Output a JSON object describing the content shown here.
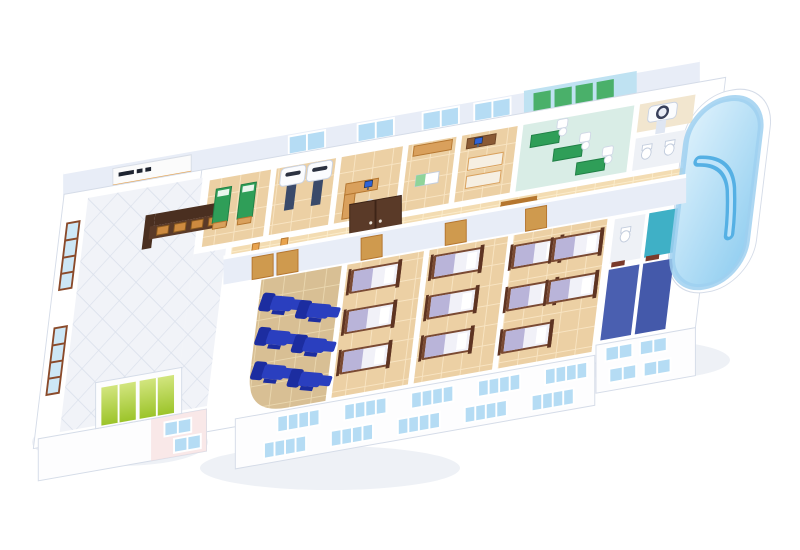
{
  "scene": {
    "title": "3D isometric cutaway floor plan of a hospital / clinic level",
    "view": "aerial isometric cutaway, building runs lower-left to upper-right on white background",
    "visible_text": "none legible (small dark glyphs on reception signboard only)"
  },
  "colors": {
    "shadow": "#eef1f6",
    "wall-edge": "#d5dce8",
    "wall-shade": "#e8edf7",
    "floor-beige": "#ecd0a4",
    "floor-tan": "#d8bf94",
    "floor-corridor": "#f3dcb2",
    "hall-tile": "#f1f3f8",
    "hall-grout": "#dbe1ec",
    "rehab-floor": "#d9ede6",
    "rehab-wall": "#bfe2f2",
    "panel-green": "#4ab06a",
    "green": "#2f9e58",
    "green-dark": "#1f7f45",
    "wood": "#d9a05c",
    "wood-dark": "#b5762f",
    "orange": "#e8a34e",
    "desk-brown": "#8a5a34",
    "chair-blue": "#2a3fbf",
    "chair-blue-dark": "#1c2da0",
    "bed-frame": "#7a4a33",
    "bed-frame-dark": "#5e3422",
    "bed-mattress": "#f1f1f8",
    "bed-blanket": "#b9b4d9",
    "scan-table": "#3a4a6a",
    "glass": "#b5dcf4",
    "glass-pale": "#cde7f6",
    "window-frame-brown": "#8a4a2a",
    "slate": "#4a5fb0",
    "slate2": "#4459aa",
    "teal": "#3fb0c6",
    "door-gold": "#cf9a4e",
    "door-red": "#7a3a2a",
    "door-brown": "#5a3a28",
    "counter-brown": "#4a2f20",
    "counter-brown2": "#5a3a28",
    "counter-orange": "#cd8a3f",
    "monitor-blue": "#2e63d8",
    "facade": "#fdfdfe",
    "pink-facade": "#f6dede",
    "elevator-green-1": "#d2e57e",
    "elevator-green-2": "#9cc42a",
    "atrium-light": "#dff2fc",
    "atrium-mid": "#8fcdf0",
    "counter-blue": "#55b0e4",
    "sign-dark": "#1e2430"
  },
  "rooms": [
    {
      "id": "reception-hall",
      "label": "Reception hall",
      "features": [
        "dark reception counter with 4 orange panels",
        "white signboard with dark glyphs and orange trim",
        "tall brown-framed windows on left wall",
        "green elevator doors",
        "white diamond tile floor"
      ]
    },
    {
      "id": "exam-room-green-beds",
      "label": "Exam room",
      "features": [
        "2 green examination beds"
      ]
    },
    {
      "id": "imaging-room",
      "label": "Imaging room",
      "features": [
        "2 white scanner gantries with dark patient tables"
      ]
    },
    {
      "id": "consult-office",
      "label": "Consulting office",
      "features": [
        "wood desk",
        "computer monitor",
        "glass sliding door"
      ]
    },
    {
      "id": "treatment-room",
      "label": "Treatment room",
      "features": [
        "wood cabinet",
        "small treatment bed"
      ]
    },
    {
      "id": "staff-office",
      "label": "Staff office",
      "features": [
        "desk with monitor",
        "2 exam tables"
      ]
    },
    {
      "id": "rehab-gym",
      "label": "Rehabilitation gym",
      "features": [
        "green wall panels",
        "3 green therapy mats",
        "white exercise machines",
        "light blue walls"
      ]
    },
    {
      "id": "ct-room",
      "label": "CT room",
      "features": [
        "white CT scanner"
      ]
    },
    {
      "id": "wc-room",
      "label": "Toilet room",
      "features": [
        "2 toilets"
      ]
    },
    {
      "id": "corridor",
      "label": "Corridor",
      "features": [
        "2 orange tables with stools",
        "2 wooden benches",
        "dark brown double door"
      ]
    },
    {
      "id": "infusion-lounge",
      "label": "Lounge",
      "features": [
        "6 blue recliner chairs",
        "curved outer corner"
      ]
    },
    {
      "id": "ward-a",
      "label": "Patient ward A",
      "features": [
        "3 wood-frame beds with lavender blankets"
      ]
    },
    {
      "id": "ward-b",
      "label": "Patient ward B",
      "features": [
        "3 wood-frame beds"
      ]
    },
    {
      "id": "ward-c",
      "label": "Patient ward C",
      "features": [
        "5 wood-frame beds"
      ]
    },
    {
      "id": "shower-block",
      "label": "Washroom block",
      "features": [
        "slate-blue tiled floors",
        "teal tiled floor",
        "toilet",
        "dark red doors"
      ]
    },
    {
      "id": "hydro-atrium",
      "label": "Curved glass atrium",
      "features": [
        "blue curved glass wall",
        "curved blue counter"
      ]
    }
  ],
  "furniture_counts": {
    "green-exam-beds": 2,
    "imaging-scanners": 2,
    "blue-recliners": 6,
    "ward-beds": 11,
    "corridor-benches": 2,
    "corridor-tables": 2,
    "stools": 6,
    "toilets": 3,
    "desks": 3,
    "computer-monitors": 3,
    "elevator-doors": 2,
    "rehab-mats": 3,
    "facade-window-groups": 12,
    "hall-windows": 2
  }
}
